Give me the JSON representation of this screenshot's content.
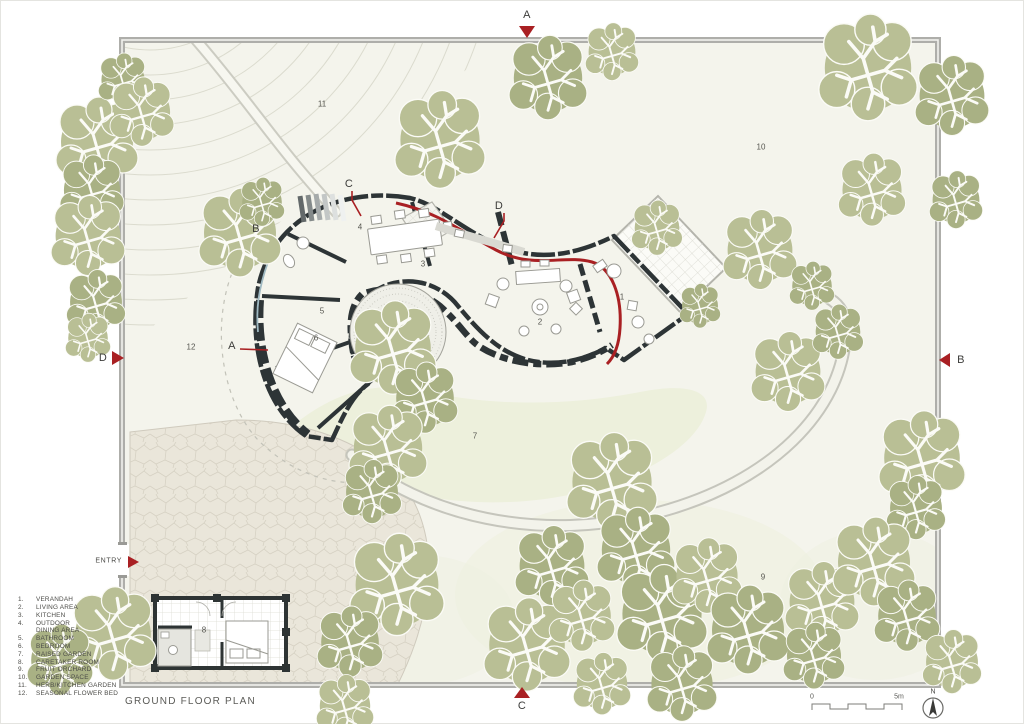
{
  "title": "GROUND FLOOR PLAN",
  "entry": "ENTRY",
  "north_label": "N",
  "scale_bar": {
    "start": "0",
    "end": "5m"
  },
  "section_markers": {
    "top": "A",
    "right": "B",
    "bottom": "C",
    "left": "D"
  },
  "plan_section_labels": {
    "a": "A",
    "b": "B",
    "c": "C",
    "d": "D"
  },
  "legend_items": [
    {
      "num": "1.",
      "label": "VERANDAH"
    },
    {
      "num": "2.",
      "label": "LIVING AREA"
    },
    {
      "num": "3.",
      "label": "KITCHEN"
    },
    {
      "num": "4.",
      "label": "OUTDOOR\nDINING AREA"
    },
    {
      "num": "5.",
      "label": "BATHROOM"
    },
    {
      "num": "6.",
      "label": "BEDROOM"
    },
    {
      "num": "7.",
      "label": "RAISED GARDEN"
    },
    {
      "num": "8.",
      "label": "CARETAKER ROOM"
    },
    {
      "num": "9.",
      "label": "FRUIT ORCHARD"
    },
    {
      "num": "10.",
      "label": "GARDEN SPACE"
    },
    {
      "num": "11.",
      "label": "HERB/KITCHEN GARDEN"
    },
    {
      "num": "12.",
      "label": "SEASONAL FLOWER BED"
    }
  ],
  "plan_numbers": [
    {
      "n": "1",
      "x": 622,
      "y": 297
    },
    {
      "n": "2",
      "x": 540,
      "y": 322
    },
    {
      "n": "3",
      "x": 423,
      "y": 264
    },
    {
      "n": "4",
      "x": 360,
      "y": 227
    },
    {
      "n": "5",
      "x": 322,
      "y": 311
    },
    {
      "n": "6",
      "x": 316,
      "y": 338
    },
    {
      "n": "7",
      "x": 475,
      "y": 436
    },
    {
      "n": "8",
      "x": 204,
      "y": 630
    },
    {
      "n": "9",
      "x": 763,
      "y": 577
    },
    {
      "n": "10",
      "x": 761,
      "y": 147
    },
    {
      "n": "11",
      "x": 322,
      "y": 104
    },
    {
      "n": "12",
      "x": 191,
      "y": 347
    }
  ],
  "colors": {
    "accent_red": "#a92023",
    "tree_green": "#b9bf95",
    "tree_green_dark": "#a9b184",
    "wall_dark": "#2d3436",
    "site_bg": "#f4f4ec",
    "boundary_gray": "#aeaeaa"
  }
}
